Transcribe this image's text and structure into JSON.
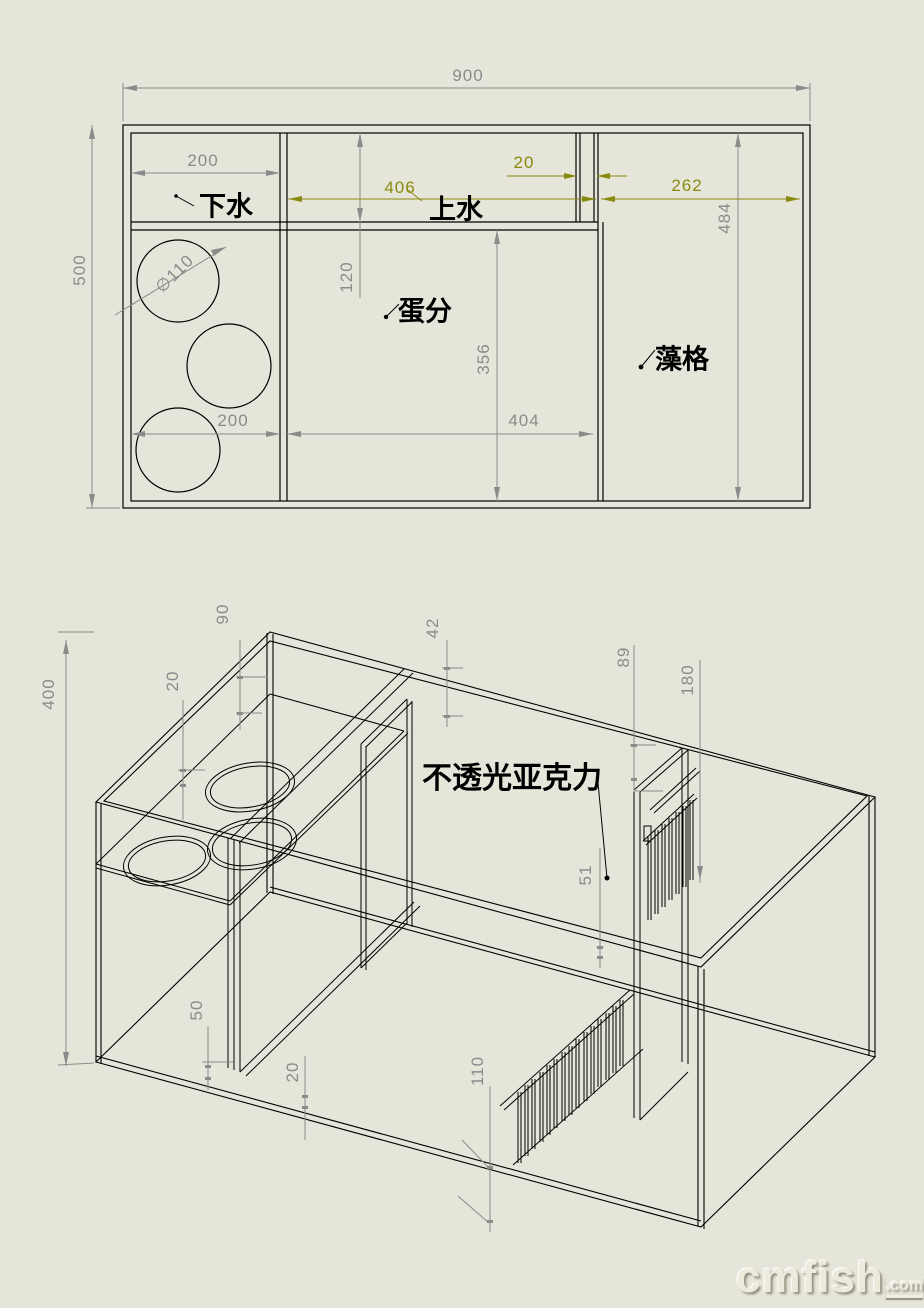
{
  "front_view": {
    "dims": {
      "overall_width": "900",
      "overall_height": "500",
      "drain_top_width": "200",
      "channel_depth": "120",
      "supply_length": "406",
      "gap_width": "20",
      "algae_top_width": "262",
      "algae_height": "484",
      "hole_diameter": "∅110",
      "sock_bottom_width": "200",
      "skimmer_width": "404",
      "skimmer_height": "356"
    },
    "labels": {
      "drain": "下水",
      "supply": "上水",
      "skimmer": "蛋分",
      "algae": "藻格"
    }
  },
  "iso_view": {
    "dims": {
      "tank_depth": "400",
      "left_gap": "20",
      "weir_height": "90",
      "top_offset": "42",
      "grate_height": "89",
      "grate_span": "180",
      "grate_offset": "51",
      "rail_height": "50",
      "rail_thickness": "20",
      "comb_height": "110"
    },
    "labels": {
      "material": "不透光亚克力"
    }
  },
  "watermark": {
    "brand": "cmfish",
    "suffix": ".com"
  },
  "colors": {
    "background": "#e6e5d9",
    "line": "#000000",
    "dimension": "#8b8b8b",
    "dimension_accent": "#8a8a10"
  }
}
